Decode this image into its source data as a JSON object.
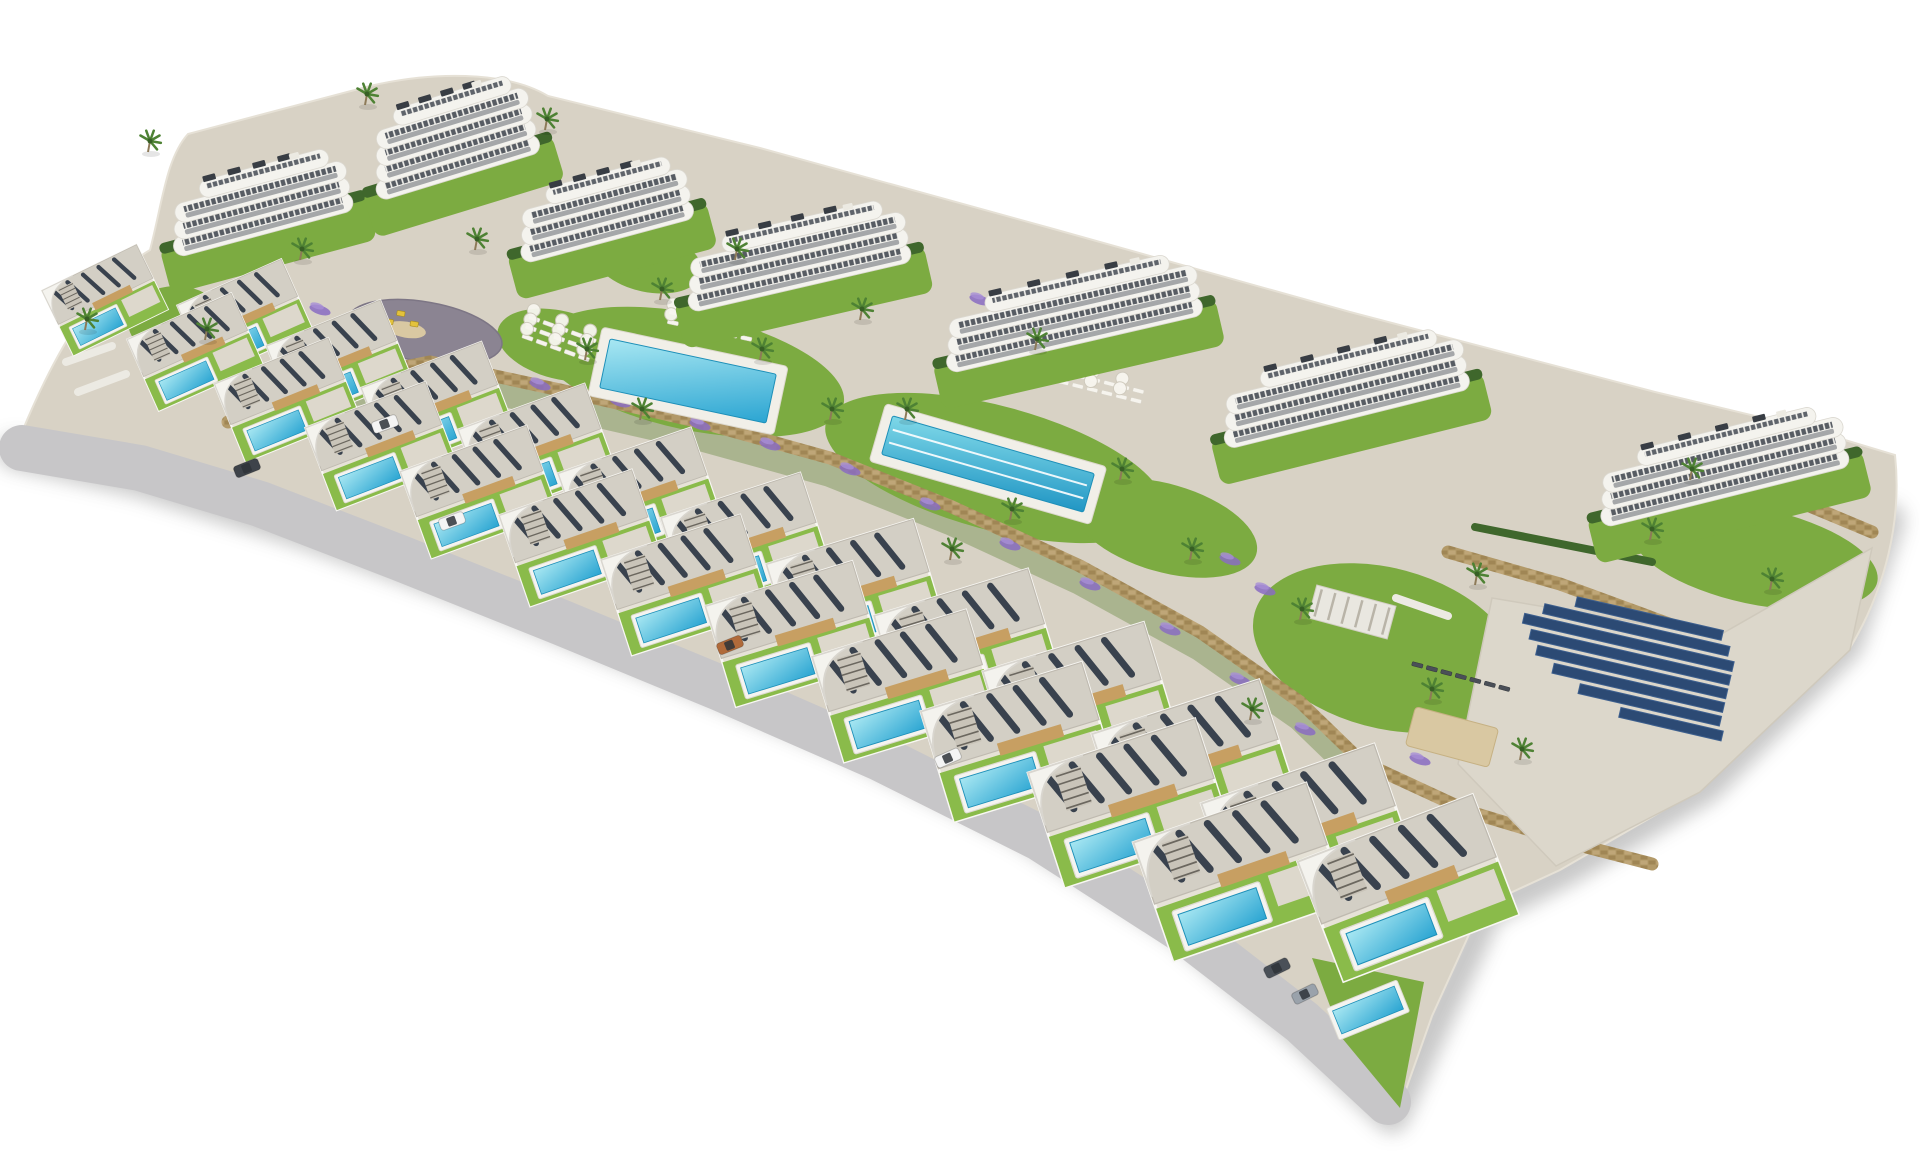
{
  "meta": {
    "description": "Aerial 3D architectural rendering of a hillside residential resort: seven white apartment buildings with curved balconies at the back, two front rows of modern flat-roof villas with private turquoise pools, two communal pools, sun-lounger decks, a playground plaza, lavender gardens, palm trees, stone retaining walls and a solar-panel field, all on a plain white background.",
    "background": "#ffffff"
  },
  "palette": {
    "paving": "#d8d2c5",
    "road": "#c7c6c8",
    "lawn": "#7cab41",
    "lawn_bright": "#8abb4a",
    "hedge": "#3f672c",
    "scrub": "#74914e",
    "building_white": "#f4f3ee",
    "band_stroke": "#dbd8d0",
    "glass_dark": "#454b54",
    "villa_roof": "#d3cfc5",
    "villa_tan": "#c79f62",
    "solar_slat": "#39424e",
    "solar_farm": "#2c4a74",
    "pool_light": "#a8e7f2",
    "pool_deep": "#2ba5d2",
    "lap_light": "#7fd8e8",
    "lap_deep": "#2196c4",
    "deck_white": "#f1efe8",
    "stone": "#b29968",
    "stone_dark": "#a08655",
    "plaza": "#8b8492",
    "sand": "#d9c8a2",
    "lavender": "#8a6cc2",
    "lavender_light": "#a78fd6",
    "palm_frond": "#4e8234",
    "trunk": "#8d7a58",
    "shadow": "#6f6f6f"
  },
  "scene": {
    "base_path": "M22,432 C60,340 100,280 150,250 C162,205 166,158 188,134 L370,86 C430,72 505,70 548,96 L760,148 L1050,228 L1350,312 L1655,392 L1805,428 L1895,455 C1902,520 1886,588 1850,648 L1702,788 L1560,870 L1482,906 L1432,1016 L1398,1112 L1308,1026 L1180,930 L1040,840 L880,760 L720,690 L560,624 L400,560 L260,506 L140,470 Z",
    "road": {
      "points": "22,448 140,468 260,504 400,558 560,622 720,688 880,758 1040,838 1180,928 1302,1022 1388,1102",
      "width": 46
    },
    "shadow": {
      "points": "14,452 140,480 300,530 480,594 660,666 840,740 1020,828 1180,928 1300,1030 1392,1116 1436,1018 1486,910 1564,870 1706,786 1846,644 1888,520",
      "width": 34,
      "opacity": 0.38
    },
    "scrub": {
      "points": "300,404 430,378 560,406 700,438 830,474 950,522 1080,582 1200,648 1300,718 1362,778",
      "width": 26,
      "opacity": 0.45
    },
    "walls": [
      {
        "points": "300,388 430,362 560,390 700,422 830,458 950,506 1080,566 1200,632 1300,702 1362,762"
      },
      {
        "points": "1362,762 1470,812 1590,848 1652,864"
      },
      {
        "points": "1448,552 1560,584 1680,628 1766,648"
      },
      {
        "points": "1700,472 1800,502 1872,532"
      },
      {
        "points": "228,422 300,388"
      }
    ],
    "hedges": [
      {
        "points": "1660,500 1858,452",
        "width": 9
      },
      {
        "points": "1475,527 1652,562",
        "width": 8
      }
    ],
    "lawns": [
      {
        "cx": 692,
        "cy": 372,
        "rx": 155,
        "ry": 58,
        "rot": 12
      },
      {
        "cx": 995,
        "cy": 468,
        "rx": 175,
        "ry": 62,
        "rot": 15
      },
      {
        "cx": 1385,
        "cy": 648,
        "rx": 135,
        "ry": 80,
        "rot": 15
      },
      {
        "cx": 1755,
        "cy": 556,
        "rx": 125,
        "ry": 48,
        "rot": 12
      },
      {
        "cx": 176,
        "cy": 322,
        "rx": 48,
        "ry": 36,
        "rot": 0
      },
      {
        "cx": 560,
        "cy": 345,
        "rx": 64,
        "ry": 34,
        "rot": 14
      },
      {
        "cx": 648,
        "cy": 262,
        "rx": 55,
        "ry": 30,
        "rot": 12
      },
      {
        "cx": 1165,
        "cy": 528,
        "rx": 95,
        "ry": 44,
        "rot": 16
      }
    ],
    "lawn_tail": "1312,958 1424,982 1400,1108 1342,1038",
    "plaza": {
      "cx": 425,
      "cy": 332,
      "rx": 78,
      "ry": 30,
      "rot": 10,
      "items": [
        [
          398,
          318
        ],
        [
          413,
          326
        ],
        [
          388,
          328
        ]
      ],
      "sand": {
        "cx": 406,
        "cy": 333,
        "rx": 20,
        "ry": 8
      }
    },
    "community_pools": [
      {
        "cx": 688,
        "cy": 381,
        "w": 190,
        "h": 70,
        "rot": 12,
        "lanes": 0,
        "grad": "poolGrad"
      },
      {
        "cx": 988,
        "cy": 464,
        "w": 230,
        "h": 60,
        "rot": 16,
        "lanes": 2,
        "grad": "lapGrad"
      }
    ],
    "lounger_patches": [
      {
        "cx": 560,
        "cy": 342,
        "rot": 20,
        "rows": 3,
        "cols": 5,
        "parasols": true,
        "dark": false
      },
      {
        "cx": 712,
        "cy": 329,
        "rot": 12,
        "rows": 2,
        "cols": 6,
        "parasols": true,
        "dark": false
      },
      {
        "cx": 1102,
        "cy": 390,
        "rot": 14,
        "rows": 2,
        "cols": 6,
        "parasols": true,
        "dark": false
      },
      {
        "cx": 1462,
        "cy": 680,
        "rot": 15,
        "rows": 1,
        "cols": 7,
        "parasols": false,
        "dark": true
      }
    ],
    "pergola": {
      "cx": 1352,
      "cy": 612,
      "w": 82,
      "h": 34,
      "rot": 15
    },
    "sand_patch": {
      "cx": 1452,
      "cy": 737,
      "w": 86,
      "h": 40,
      "rot": 15
    },
    "solar": {
      "cx": 1628,
      "cy": 666,
      "rot": 13,
      "row_gap": 14,
      "row_h": 10,
      "rows": [
        [
          150,
          10
        ],
        [
          190,
          0
        ],
        [
          215,
          -5
        ],
        [
          205,
          0
        ],
        [
          195,
          5
        ],
        [
          175,
          15
        ],
        [
          145,
          30
        ],
        [
          105,
          55
        ]
      ],
      "apron": "1492,598 1718,636 1872,548 1850,650 1700,792 1556,866 1458,764"
    },
    "apartments": [
      [
        258,
        205,
        185,
        3,
        -15
      ],
      [
        452,
        148,
        170,
        4,
        -17
      ],
      [
        602,
        212,
        178,
        3,
        -15
      ],
      [
        795,
        258,
        228,
        3,
        -13
      ],
      [
        1070,
        315,
        262,
        3,
        -13
      ],
      [
        1342,
        390,
        252,
        3,
        -14
      ],
      [
        1720,
        468,
        255,
        3,
        -14
      ]
    ],
    "villas": [
      [
        105,
        300,
        0.72,
        -26
      ],
      [
        195,
        352,
        0.78,
        -24
      ],
      [
        287,
        400,
        0.84,
        -22
      ],
      [
        381,
        446,
        0.88,
        -21
      ],
      [
        479,
        492,
        0.92,
        -20
      ],
      [
        581,
        538,
        0.96,
        -19
      ],
      [
        686,
        585,
        1.0,
        -18
      ],
      [
        794,
        634,
        1.05,
        -17
      ],
      [
        905,
        686,
        1.1,
        -17
      ],
      [
        1018,
        742,
        1.15,
        -17
      ],
      [
        1130,
        803,
        1.2,
        -18
      ],
      [
        1240,
        872,
        1.25,
        -19
      ],
      [
        245,
        318,
        0.78,
        -24
      ],
      [
        339,
        362,
        0.84,
        -22
      ],
      [
        437,
        406,
        0.88,
        -21
      ],
      [
        537,
        450,
        0.92,
        -20
      ],
      [
        640,
        496,
        0.96,
        -19
      ],
      [
        746,
        543,
        1.0,
        -18
      ],
      [
        855,
        592,
        1.05,
        -17
      ],
      [
        967,
        645,
        1.1,
        -17
      ],
      [
        1080,
        702,
        1.15,
        -17
      ],
      [
        1194,
        764,
        1.2,
        -18
      ],
      [
        1308,
        833,
        1.25,
        -19
      ],
      [
        1408,
        888,
        1.28,
        -21
      ]
    ],
    "extra_pools": [
      [
        1368,
        1010,
        -22,
        0.95
      ]
    ],
    "stairs": [
      [
        66,
        362,
        112,
        346
      ],
      [
        78,
        392,
        126,
        374
      ],
      [
        1396,
        598,
        1448,
        616
      ]
    ],
    "palms": [
      [
        148,
        152
      ],
      [
        365,
        105
      ],
      [
        545,
        130
      ],
      [
        300,
        260
      ],
      [
        475,
        250
      ],
      [
        660,
        300
      ],
      [
        585,
        360
      ],
      [
        640,
        420
      ],
      [
        760,
        360
      ],
      [
        830,
        420
      ],
      [
        905,
        420
      ],
      [
        1010,
        520
      ],
      [
        1120,
        480
      ],
      [
        950,
        560
      ],
      [
        1190,
        560
      ],
      [
        1300,
        620
      ],
      [
        1430,
        700
      ],
      [
        1520,
        760
      ],
      [
        1250,
        720
      ],
      [
        1650,
        540
      ],
      [
        1770,
        590
      ],
      [
        1690,
        480
      ],
      [
        860,
        320
      ],
      [
        1035,
        350
      ],
      [
        735,
        260
      ],
      [
        205,
        340
      ],
      [
        85,
        330
      ],
      [
        1475,
        585
      ]
    ],
    "lavender": [
      [
        470,
        370
      ],
      [
        540,
        385
      ],
      [
        620,
        402
      ],
      [
        700,
        425
      ],
      [
        770,
        445
      ],
      [
        850,
        470
      ],
      [
        930,
        505
      ],
      [
        1010,
        545
      ],
      [
        1090,
        585
      ],
      [
        1170,
        630
      ],
      [
        1240,
        680
      ],
      [
        1305,
        730
      ],
      [
        260,
        300
      ],
      [
        320,
        310
      ],
      [
        1560,
        620
      ],
      [
        1620,
        700
      ],
      [
        1420,
        760
      ],
      [
        980,
        300
      ],
      [
        1230,
        560
      ],
      [
        1265,
        590
      ]
    ],
    "cars": [
      [
        385,
        424,
        -20,
        "#f4f4f4"
      ],
      [
        247,
        468,
        -22,
        "#3e434a"
      ],
      [
        948,
        758,
        -24,
        "#f4f4f4"
      ],
      [
        1277,
        968,
        -26,
        "#4a5058"
      ],
      [
        1305,
        994,
        -26,
        "#9aa2ab"
      ],
      [
        452,
        521,
        -20,
        "#f4f4f4"
      ],
      [
        730,
        645,
        -22,
        "#b06a3a"
      ]
    ],
    "counts": {
      "apartment_buildings": 7,
      "villas": 24,
      "private_pools": 25,
      "community_pools": 2,
      "playgrounds": 1,
      "solar_arrays": 1
    }
  }
}
